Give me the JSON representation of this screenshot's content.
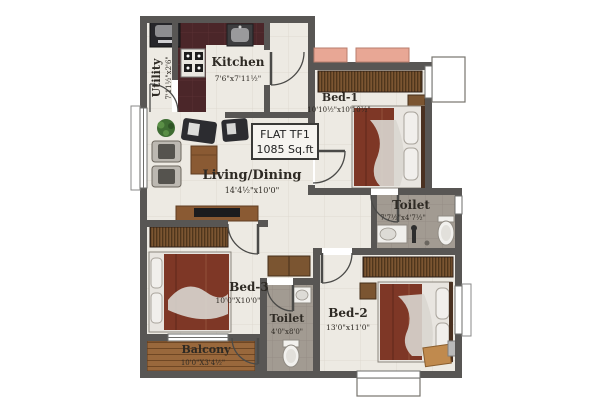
{
  "plan": {
    "flat_label": {
      "line1": "FLAT TF1",
      "line2": "1085 Sq.ft"
    },
    "rooms": {
      "utility": {
        "name": "Utility",
        "dim": "7'11½\"x2'6\""
      },
      "kitchen": {
        "name": "Kitchen",
        "dim": "7'6\"x7'11½\""
      },
      "living": {
        "name": "Living/Dining",
        "dim": "14'4½\"x10'0\""
      },
      "bed1": {
        "name": "Bed-1",
        "dim": "10'10½\"x10'10½\""
      },
      "toilet1": {
        "name": "Toilet",
        "dim": "7'7½\"x4'7½\""
      },
      "bed3": {
        "name": "Bed-3",
        "dim": "10'0\"X10'0\""
      },
      "toilet2": {
        "name": "Toilet",
        "dim": "4'0\"x8'0\""
      },
      "bed2": {
        "name": "Bed-2",
        "dim": "13'0\"x11'0\""
      },
      "balcony": {
        "name": "Balcony",
        "dim": "10'0\"X3'4½\""
      }
    },
    "colors": {
      "wall": "#585654",
      "floor_tile": "#edeae3",
      "kitchen_counter": "#4b2629",
      "toilet_floor": "#a29b92",
      "balcony_wood": "#99683c",
      "wardrobe_wood": "#7b5531",
      "bed_blanket": "#7e3726",
      "ledge_pink": "#e8a795",
      "linen_white": "#e8e5e0"
    }
  }
}
